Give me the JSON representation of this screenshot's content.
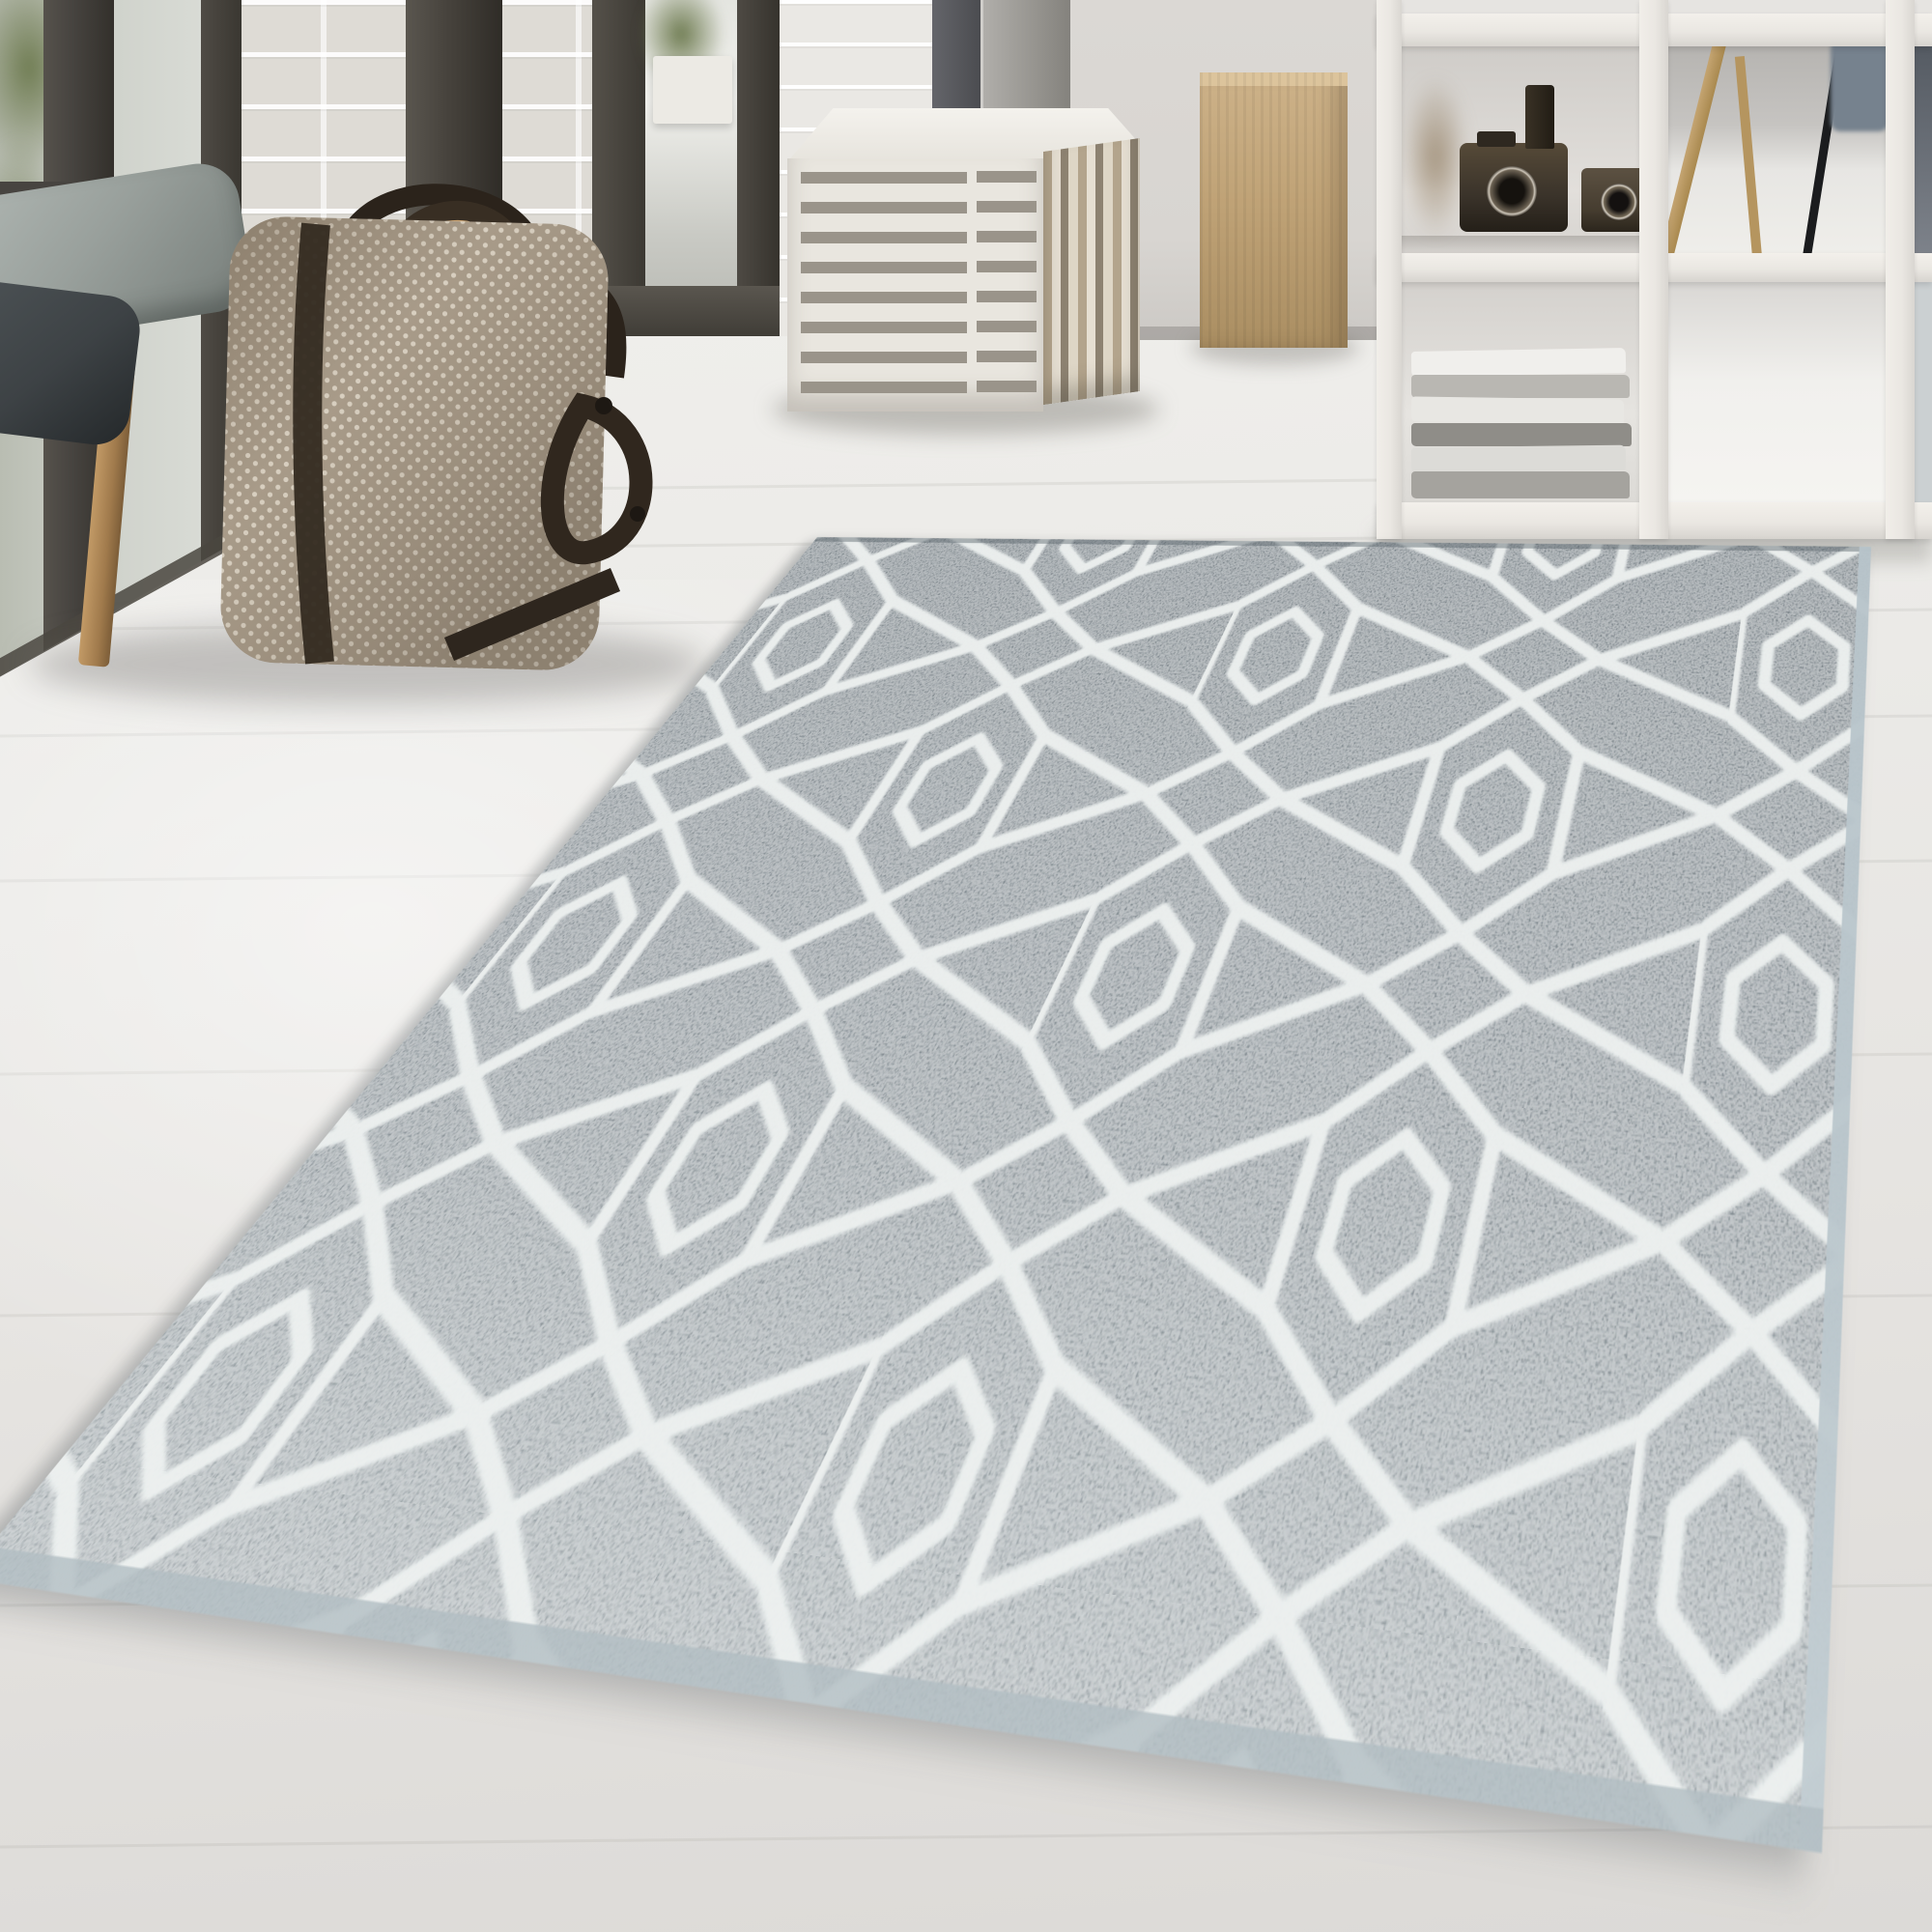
{
  "meta": {
    "type": "interior product photograph",
    "subject": "grey rug with white geometric hexagon trellis pattern in a bright living room",
    "visible_text": "none"
  },
  "theme": {
    "floor-light": "#f0efec",
    "floor-mid": "#e6e4e1",
    "floor-dark": "#dcdad7",
    "wall": "#d8d5d1",
    "wall-bright": "#eae8e4",
    "brick": "#dedbd5",
    "frame-dark": "#474440",
    "plant-green": "#6f7c52",
    "shelf-white": "#eae7e2",
    "wood-light": "#c9a271",
    "wood-mid": "#ad8753",
    "wood-dark": "#8a683f",
    "pillow-grey": "#99a09c",
    "pillow-dark": "#3d4245",
    "bag-base": "#a89b89",
    "bag-dot": "#d8cfc0",
    "strap-dark": "#342b21",
    "pouf-white": "#e9e6df",
    "pouf-stripe-grey": "#9a948a",
    "pouf-stripe-tan": "#b3a48c",
    "pouf-tan-light": "#cdb289",
    "pouf-tan-dark": "#aa8e62",
    "camera-dark": "#3a332a",
    "rug-grey-dark": "#6d777d",
    "rug-grey": "#7c868c",
    "rug-grey-light": "#949ea2",
    "rug-pattern-white": "#edf1f0",
    "rug-binding": "#b7c4ca",
    "shadow": "rgba(90,94,97,0.38)"
  },
  "scene": {
    "room_objects": [
      "floor-to-ceiling window with dark frames",
      "white painted brick wall",
      "open glass door with greenery outside",
      "rustic wooden bench",
      "grey cushion",
      "dark charcoal cushion",
      "woven dotted weekender bag with dark leather straps",
      "white and grey striped cube pouf",
      "tan cube pouf",
      "white open cube shelving unit",
      "two vintage cameras and bottles",
      "stack of folded magazines",
      "wooden easel",
      "black floor lamp pole",
      "grey chair",
      "pale whitewashed wood floor"
    ],
    "rug": {
      "shape": "rectangular, laid diagonally in perspective",
      "pile": "short pile, mottled heather texture",
      "base_color": "grey",
      "pattern_color": "white",
      "pattern": "chains of elongated hexagons with inner hexagons, joined by diamonds and lattice arrow bands",
      "edge": "light blue-grey binding on right and bottom edges"
    }
  }
}
